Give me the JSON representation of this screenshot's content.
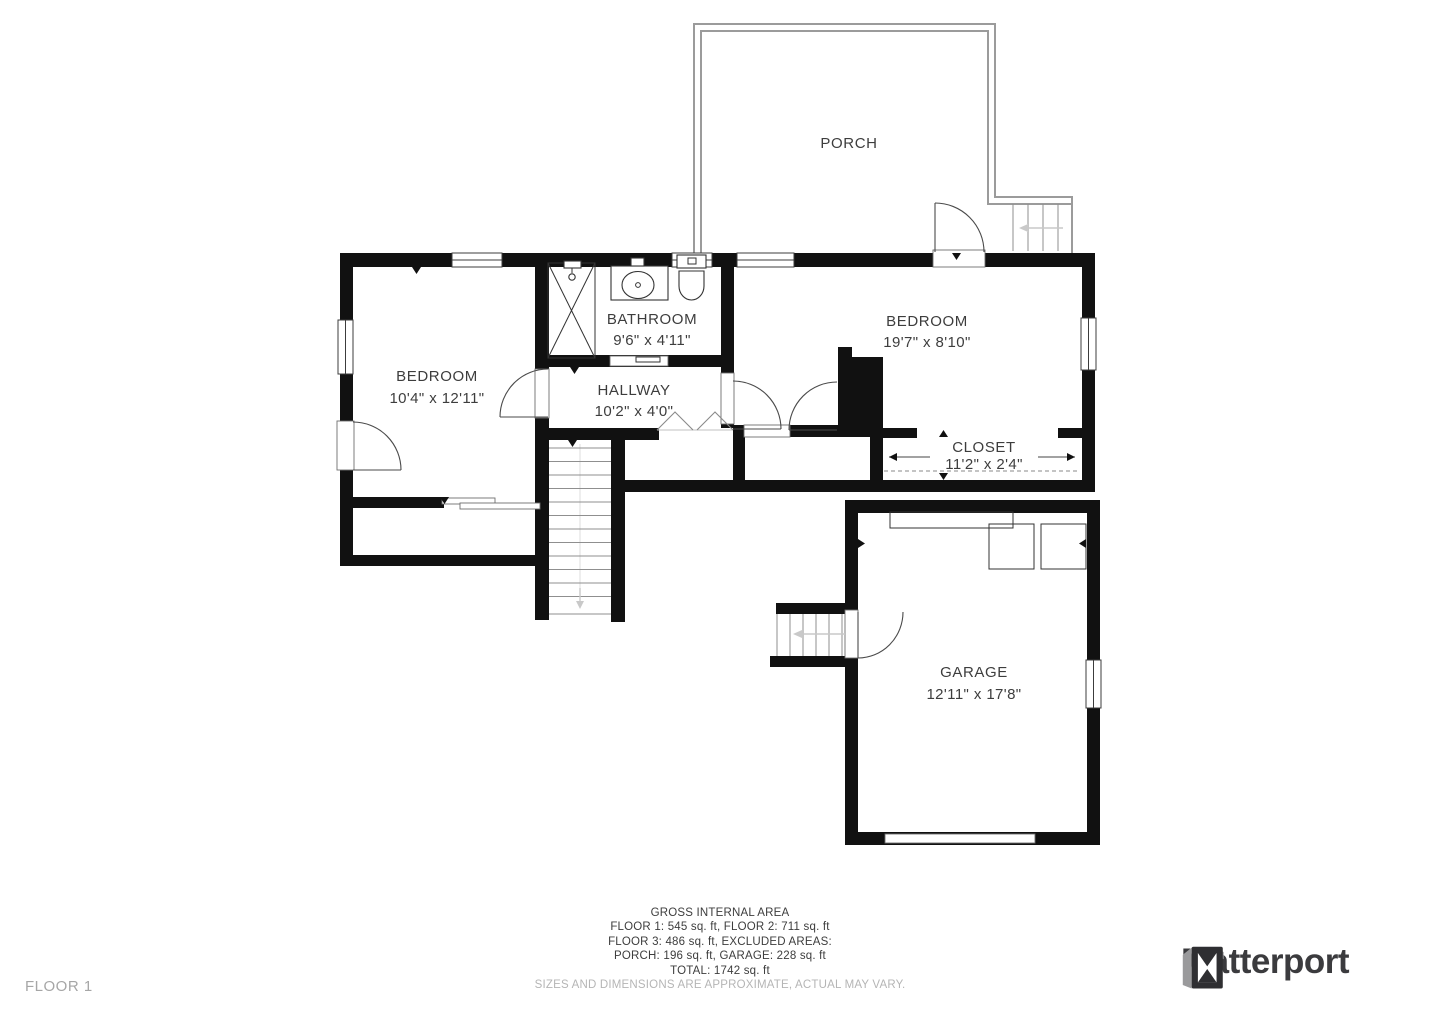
{
  "meta": {
    "floor_label": "FLOOR 1"
  },
  "rooms": {
    "porch": {
      "label": "PORCH",
      "dims": ""
    },
    "bathroom": {
      "label": "BATHROOM",
      "dims": "9'6\" x 4'11\""
    },
    "bedroom_right": {
      "label": "BEDROOM",
      "dims": "19'7\" x 8'10\""
    },
    "bedroom_left": {
      "label": "BEDROOM",
      "dims": "10'4\" x 12'11\""
    },
    "hallway": {
      "label": "HALLWAY",
      "dims": "10'2\" x 4'0\""
    },
    "closet": {
      "label": "CLOSET",
      "dims": "11'2\" x 2'4\""
    },
    "garage": {
      "label": "GARAGE",
      "dims": "12'11\" x 17'8\""
    }
  },
  "footer": {
    "title": "GROSS INTERNAL AREA",
    "line1": "FLOOR 1: 545 sq. ft, FLOOR 2: 711 sq. ft",
    "line2": "FLOOR 3: 486 sq. ft, EXCLUDED AREAS:",
    "line3": "PORCH: 196 sq. ft, GARAGE: 228 sq. ft",
    "line4": "TOTAL: 1742 sq. ft",
    "disclaimer": "SIZES AND DIMENSIONS ARE APPROXIMATE, ACTUAL MAY VARY."
  },
  "brand": {
    "wordmark": "Matterport"
  },
  "icons": {
    "logo": "matterport-cube-icon"
  },
  "colors": {
    "wall": "#111111",
    "thin_line": "#9b9b9b",
    "label_text": "#3d3d3d",
    "muted_text": "#b5b5b5",
    "floor_text": "#a6a6a6",
    "logo_text": "#3b3b3e"
  }
}
